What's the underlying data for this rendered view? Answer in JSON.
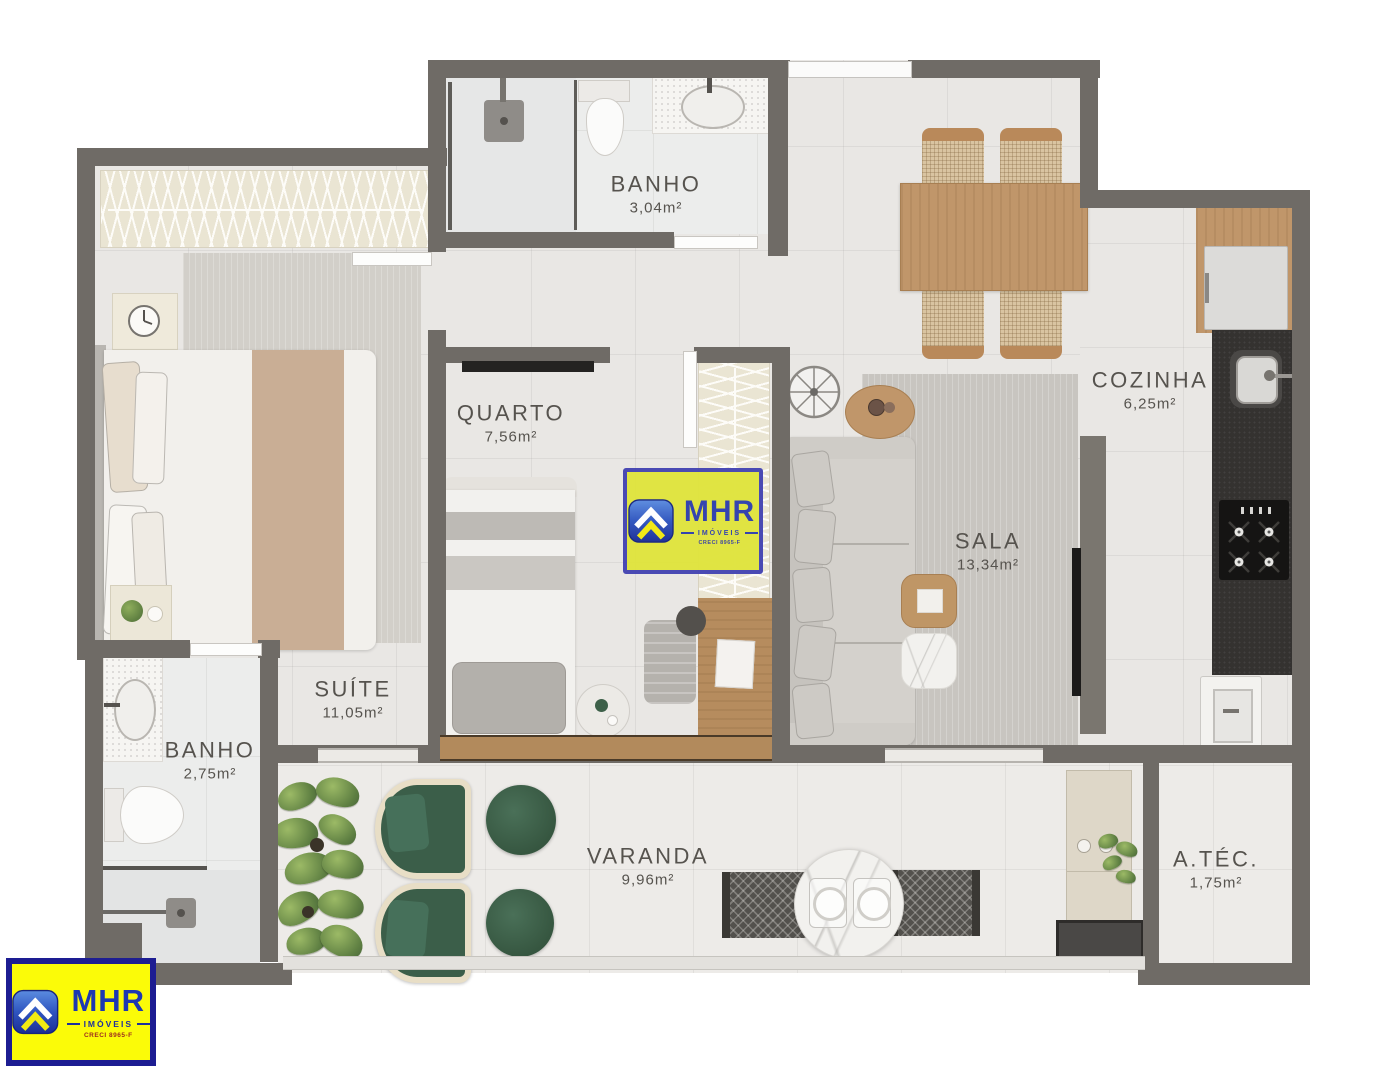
{
  "rooms": [
    {
      "key": "banho_social",
      "name": "BANHO",
      "area": "3,04m²"
    },
    {
      "key": "cozinha",
      "name": "COZINHA",
      "area": "6,25m²"
    },
    {
      "key": "quarto",
      "name": "QUARTO",
      "area": "7,56m²"
    },
    {
      "key": "sala",
      "name": "SALA",
      "area": "13,34m²"
    },
    {
      "key": "suite",
      "name": "SUÍTE",
      "area": "11,05m²"
    },
    {
      "key": "banho_suite",
      "name": "BANHO",
      "area": "2,75m²"
    },
    {
      "key": "varanda",
      "name": "VARANDA",
      "area": "9,96m²"
    },
    {
      "key": "area_tecnica",
      "name": "A.TÉC.",
      "area": "1,75m²"
    }
  ],
  "watermark": {
    "brand": "MHR",
    "subtitle": "IMÓVEIS",
    "license": "CRECI 8965-F",
    "icon": "roof-chevron-icon",
    "bg": "#e0e43e",
    "border": "#4545b2"
  },
  "corner_logo": {
    "brand": "MHR",
    "subtitle": "IMÓVEIS",
    "license": "CRECI 8965-F",
    "icon": "roof-chevron-icon",
    "bg": "#fbfb08",
    "border": "#1d1d92"
  },
  "palette": {
    "wall": "#6f6b66",
    "floor": "#e9e7e4",
    "wood": "#c0966a",
    "dark_counter": "#343230",
    "green": "#3b5e49",
    "rug": "#c8c5c0"
  }
}
